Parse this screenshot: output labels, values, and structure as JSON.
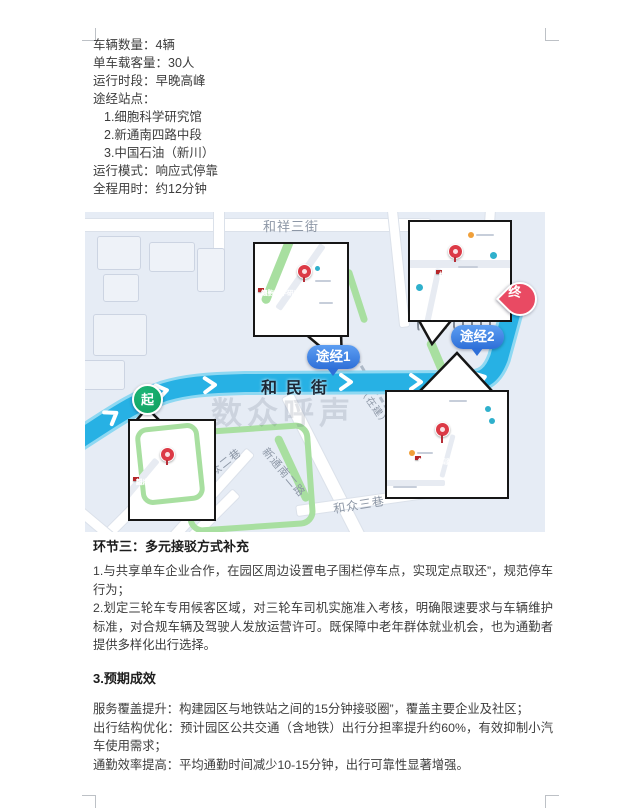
{
  "doc": {
    "specs": [
      "车辆数量：4辆",
      "单车载客量：30人",
      "运行时段：早晚高峰",
      "途经站点：",
      "1.细胞科学研究馆",
      "2.新通南四路中段",
      "3.中国石油（新川）",
      "运行模式：响应式停靠",
      "全程用时：约12分钟"
    ],
    "section3_heading": "环节三：多元接驳方式补充",
    "section3_paragraphs": [
      "1.与共享单车企业合作，在园区周边设置电子围栏停车点，实现定点取还”，规范停车行为；",
      "2.划定三轮车专用候客区域，对三轮车司机实施准入考核，明确限速要求与车辆维护标准，对合规车辆及驾驶人发放运营许可。既保障中老年群体就业机会，也为通勤者提供多样化出行选择。"
    ],
    "section4_heading": "3.预期成效",
    "section4_paragraphs": [
      "服务覆盖提升：构建园区与地铁站之间的15分钟接驳圈”，覆盖主要企业及社区；",
      "出行结构优化：预计园区公共交通（含地铁）出行分担率提升约60%，有效抑制小汽车使用需求；",
      "通勤效率提高：平均通勤时间减少10-15分钟，出行可靠性显著增强。"
    ]
  },
  "map": {
    "watermark": "数众呼声",
    "route_street": "和民街",
    "street_labels": {
      "top_street": "和祥三街",
      "under_construction": "在建",
      "diag_under_construction": "（在建）",
      "lane2": "和众二巷",
      "road_s2": "新通南二路",
      "lane3": "和众三巷",
      "lane_hou": "四厚巷"
    },
    "markers": {
      "start": "起",
      "waypoint1": "途经1",
      "waypoint2": "途经2",
      "end": "终"
    },
    "callouts": [
      {
        "id": "stop1",
        "line1": "第一站：",
        "line2": "细胞科学研究馆"
      },
      {
        "id": "terminal",
        "line1": "终点站：",
        "line2": "中国石油（新川）"
      },
      {
        "id": "start",
        "line1": "起点站：",
        "line2": "新川路与和民街路口"
      },
      {
        "id": "stop2",
        "line1": "第二站：",
        "line2": "新通南四路中段"
      }
    ],
    "colors": {
      "route": "#27b1e4",
      "route_casing": "#8ed8f2",
      "start_marker": "#0f9e5d",
      "waypoint_marker": "#2e6fd8",
      "end_marker": "#e94a63",
      "callout_label_bg": "#b5272a",
      "map_background": "#e6ecf5",
      "green_path": "#a8dfa0"
    }
  }
}
